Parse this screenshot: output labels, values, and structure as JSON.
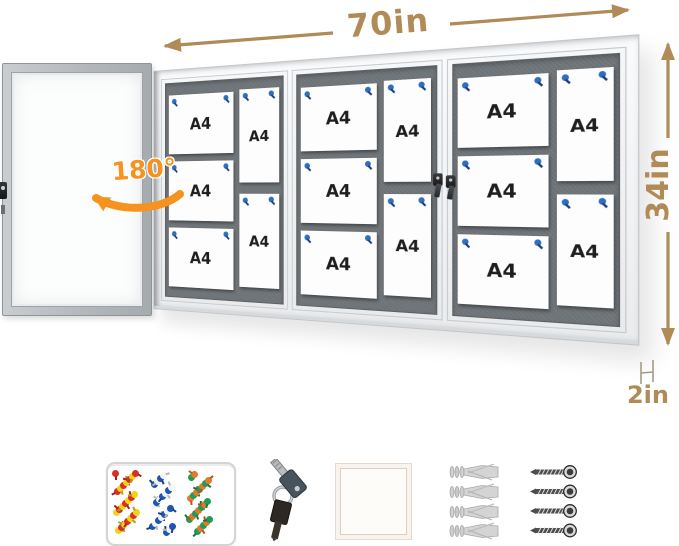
{
  "product": {
    "annotations": {
      "width_label": "70in",
      "height_label": "34in",
      "depth_label": "2in",
      "door_swing_label": "180°"
    },
    "board": {
      "paper_label": "A4",
      "section_count": 3,
      "papers_per_section": 5
    },
    "colors": {
      "dimension_accent": "#b08a57",
      "swing_accent": "#f6921e",
      "felt_gray": "#6e7377",
      "pin_blue": "#2e6fc1",
      "frame_white": "#f4f5f6"
    },
    "accessories": {
      "items": [
        "push-pin-box",
        "keys",
        "paper-pad",
        "wall-anchors",
        "screws"
      ],
      "anchor_count": 4,
      "screw_count": 4,
      "pin_palette": [
        "#d93025",
        "#1f56b3",
        "#1d9e55",
        "#f3d21a",
        "#f5f5f5",
        "#e8762c"
      ]
    }
  }
}
